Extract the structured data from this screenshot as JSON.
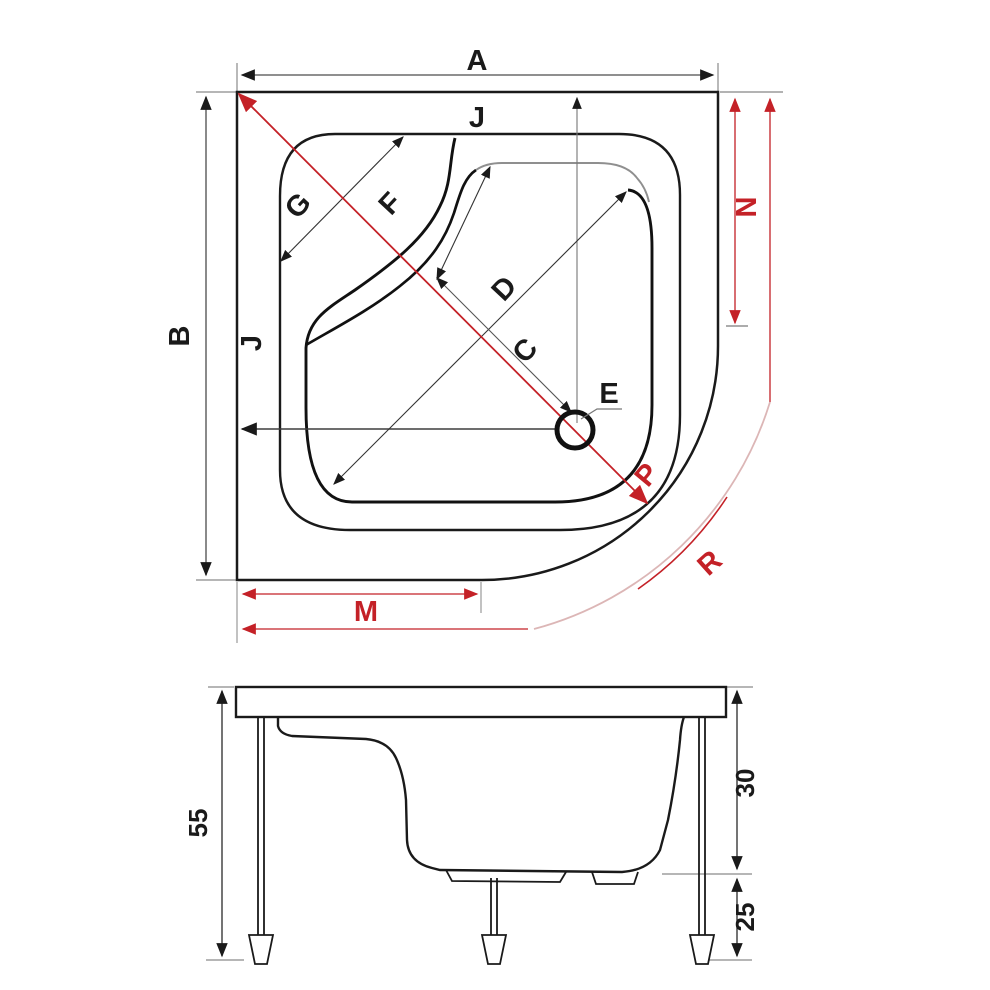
{
  "page": {
    "background": "#ffffff"
  },
  "colors": {
    "line_black": "#1a1a1a",
    "dim_red": "#c42127",
    "dim_grey": "#6e6e6e",
    "faint_pink": "#dcb6b6"
  },
  "plan": {
    "labels": {
      "overall_width": "A",
      "overall_depth": "B",
      "drain_diagonal": "C",
      "basin_diagonal": "D",
      "drain": "E",
      "seat_diagonal": "F",
      "rim_corner_diagonal": "G",
      "rim_edge_top": "J",
      "rim_edge_left": "J",
      "front_edge_length": "M",
      "side_straight_length": "N",
      "corner_diagonal": "P",
      "corner_radius": "R"
    }
  },
  "side": {
    "labels": {
      "total_height": "55",
      "tray_depth": "30",
      "leg_clearance": "25"
    }
  }
}
